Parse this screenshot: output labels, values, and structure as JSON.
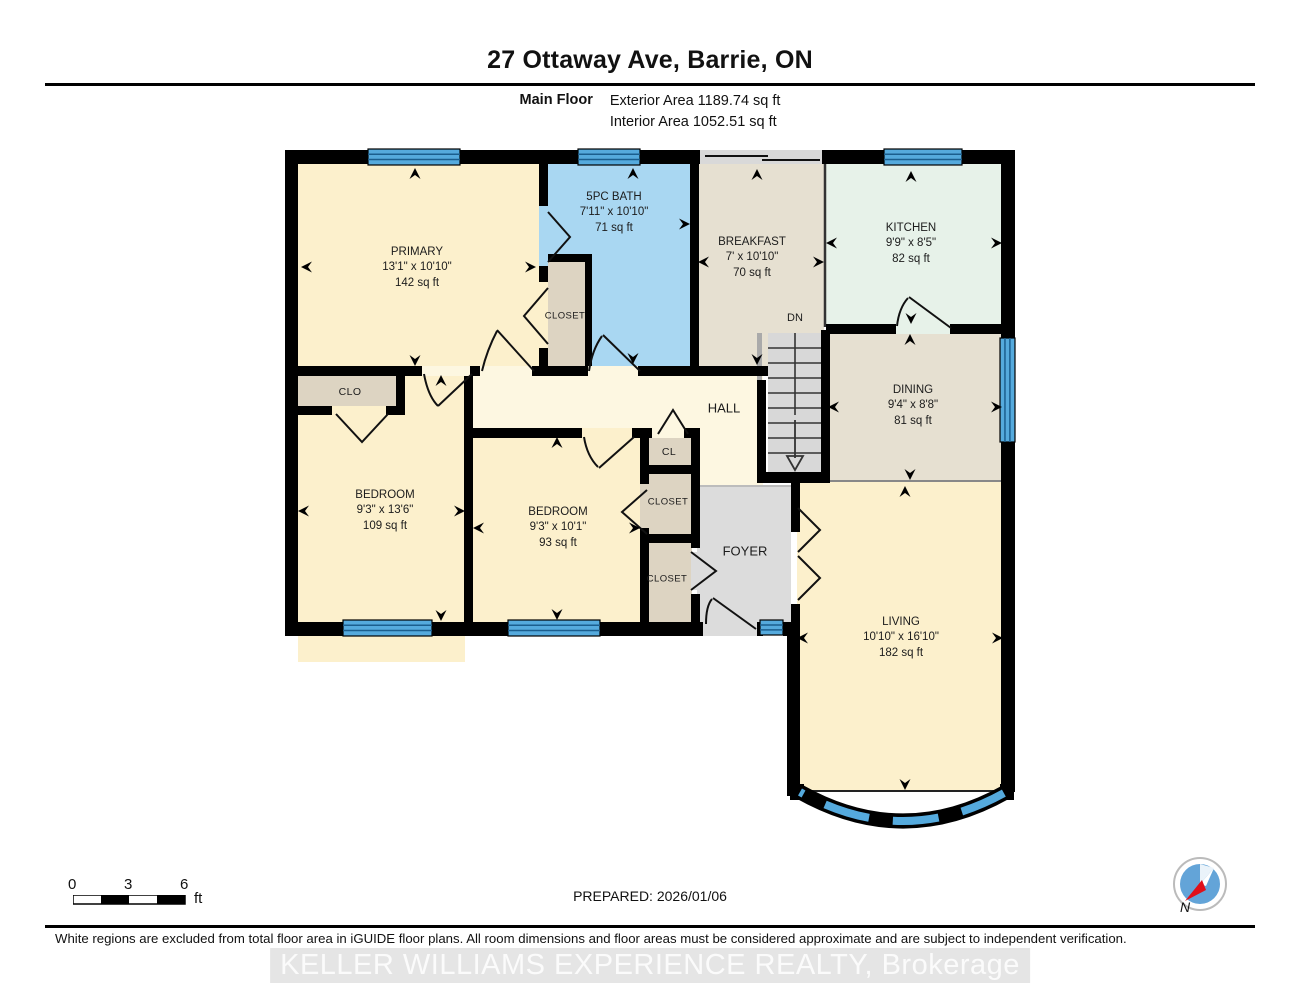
{
  "page": {
    "title": "27 Ottaway Ave, Barrie, ON"
  },
  "header": {
    "floor_label": "Main Floor",
    "exterior_area": "Exterior Area 1189.74 sq ft",
    "interior_area": "Interior Area 1052.51 sq ft"
  },
  "rooms": [
    {
      "id": "primary",
      "name": "PRIMARY",
      "dims": "13'1\" x 10'10\"",
      "area": "142 sq ft"
    },
    {
      "id": "bath",
      "name": "5PC BATH",
      "dims": "7'11\" x 10'10\"",
      "area": "71 sq ft"
    },
    {
      "id": "breakfast",
      "name": "BREAKFAST",
      "dims": "7' x 10'10\"",
      "area": "70 sq ft"
    },
    {
      "id": "kitchen",
      "name": "KITCHEN",
      "dims": "9'9\" x 8'5\"",
      "area": "82 sq ft"
    },
    {
      "id": "dining",
      "name": "DINING",
      "dims": "9'4\" x 8'8\"",
      "area": "81 sq ft"
    },
    {
      "id": "bedroom-left",
      "name": "BEDROOM",
      "dims": "9'3\" x 13'6\"",
      "area": "109 sq ft"
    },
    {
      "id": "bedroom-right",
      "name": "BEDROOM",
      "dims": "9'3\" x 10'1\"",
      "area": "93 sq ft"
    },
    {
      "id": "living",
      "name": "LIVING",
      "dims": "10'10\" x 16'10\"",
      "area": "182 sq ft"
    }
  ],
  "labels": {
    "hall": "HALL",
    "foyer": "FOYER",
    "closet": "CLOSET",
    "clo": "CLO",
    "cl": "CL",
    "dn": "DN"
  },
  "scale_bar": {
    "start": "0",
    "mid": "3",
    "end": "6",
    "unit": "ft"
  },
  "compass": {
    "label": "N"
  },
  "footer": {
    "prepared": "PREPARED: 2026/01/06",
    "disclaimer": "White regions are excluded from total floor area in iGUIDE floor plans. All room dimensions and floor areas must be considered approximate and are subject to independent verification.",
    "watermark": "KELLER WILLIAMS EXPERIENCE REALTY, Brokerage"
  },
  "colors": {
    "wall": "#000000",
    "window_blue": "#55aadd",
    "window_line": "#1b5e8e",
    "room_cream": "#fcf0cc",
    "hall_cream": "#fdf7e1",
    "room_tan": "#e6e0d1",
    "room_mint": "#e7f2e9",
    "bath_blue": "#a9d7f2",
    "closet_tan": "#ddd4c2",
    "foyer_gray": "#dcdcdc",
    "stair_gray": "#d8d8d8"
  }
}
